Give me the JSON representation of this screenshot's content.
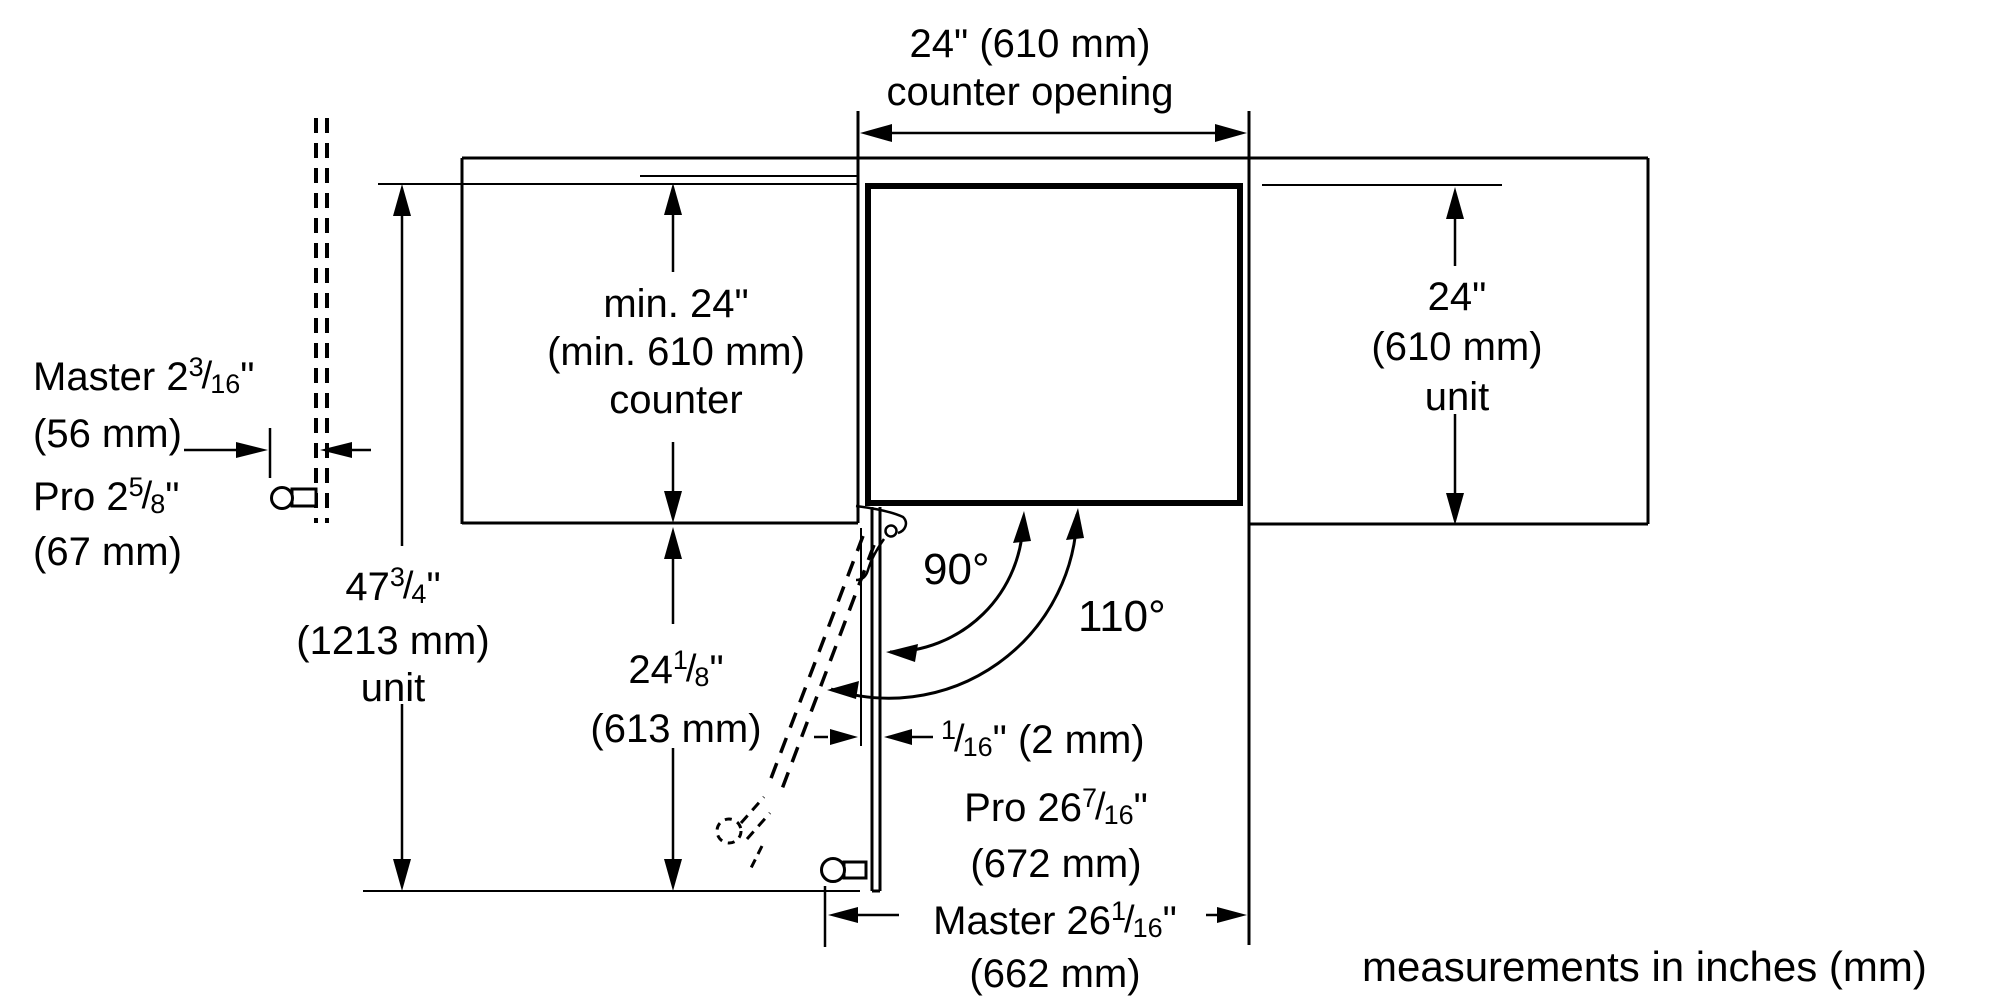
{
  "figure": {
    "kind": "built-in dishwasher installation dimension diagram",
    "note": "measurements in inches (mm)",
    "line_color": "#000000",
    "background": "#ffffff"
  },
  "dimensions": {
    "counter_opening": {
      "line1": "24\" (610 mm)",
      "line2": "counter opening"
    },
    "counter_depth": {
      "line1": "min. 24\"",
      "line2": "(min. 610 mm)",
      "line3": "counter"
    },
    "unit_depth": {
      "line1": "24\"",
      "line2": "(610 mm)",
      "line3": "unit"
    },
    "master_offset": {
      "prefix": "Master 2",
      "frac": "3/16",
      "suffix": "\"",
      "metric": "(56 mm)"
    },
    "pro_offset": {
      "prefix": "Pro 2",
      "frac": "5/8",
      "suffix": "\"",
      "metric": "(67 mm)"
    },
    "unit_height": {
      "prefix": "47",
      "frac": "3/4",
      "suffix": "\"",
      "metric": "(1213 mm)",
      "line3": "unit"
    },
    "door_projection": {
      "prefix": "24",
      "frac": "1/8",
      "suffix": "\"",
      "metric": "(613 mm)"
    },
    "reveal_gap": {
      "prefix": "",
      "frac": "1/16",
      "suffix": "\" (2 mm)"
    },
    "pro_clearance": {
      "prefix": "Pro 26",
      "frac": "7/16",
      "suffix": "\"",
      "metric": "(672 mm)"
    },
    "master_clearance": {
      "prefix": "Master 26",
      "frac": "1/16",
      "suffix": "\"",
      "metric": "(662 mm)"
    },
    "door_angle_90": "90°",
    "door_angle_110": "110°"
  }
}
